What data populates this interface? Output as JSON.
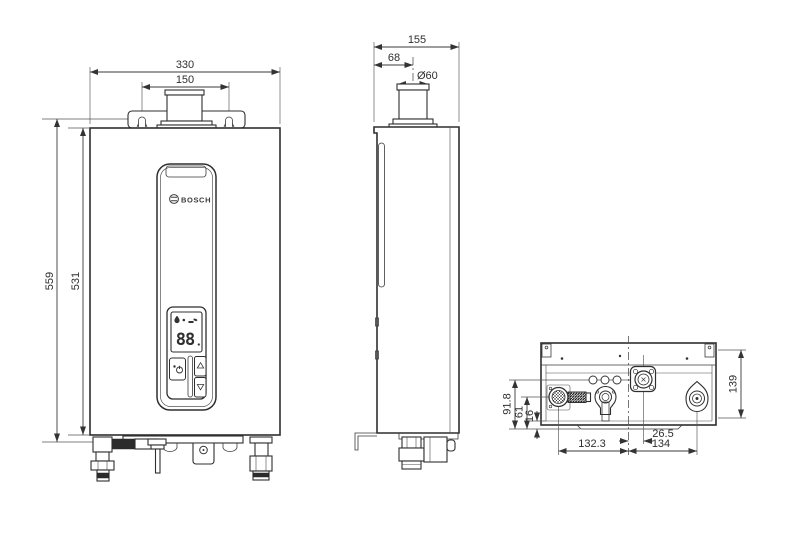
{
  "drawing": {
    "title": "water-heater-dimensional-drawing",
    "colors": {
      "line": "#2f2f2f",
      "background": "#ffffff"
    },
    "panel": {
      "brand": "BOSCH",
      "display_value": "88"
    },
    "icons": {
      "display_water_drop": "drop",
      "display_flame_dot": "dot",
      "display_faucet": "faucet",
      "power_button": "power",
      "up_button": "triangle-up",
      "down_button": "triangle-down"
    },
    "front": {
      "width": "330",
      "slot_spacing": "150",
      "overall_height": "559",
      "cabinet_height": "531"
    },
    "side": {
      "depth": "155",
      "flue_offset": "68",
      "flue_diameter": "Ø60"
    },
    "bottom": {
      "depth": "139",
      "water_offset": "91.8",
      "gas_offset": "61",
      "front_offset": "16",
      "center_to_water": "26.5",
      "gas_to_center": "132.3",
      "center_to_right": "134"
    }
  }
}
